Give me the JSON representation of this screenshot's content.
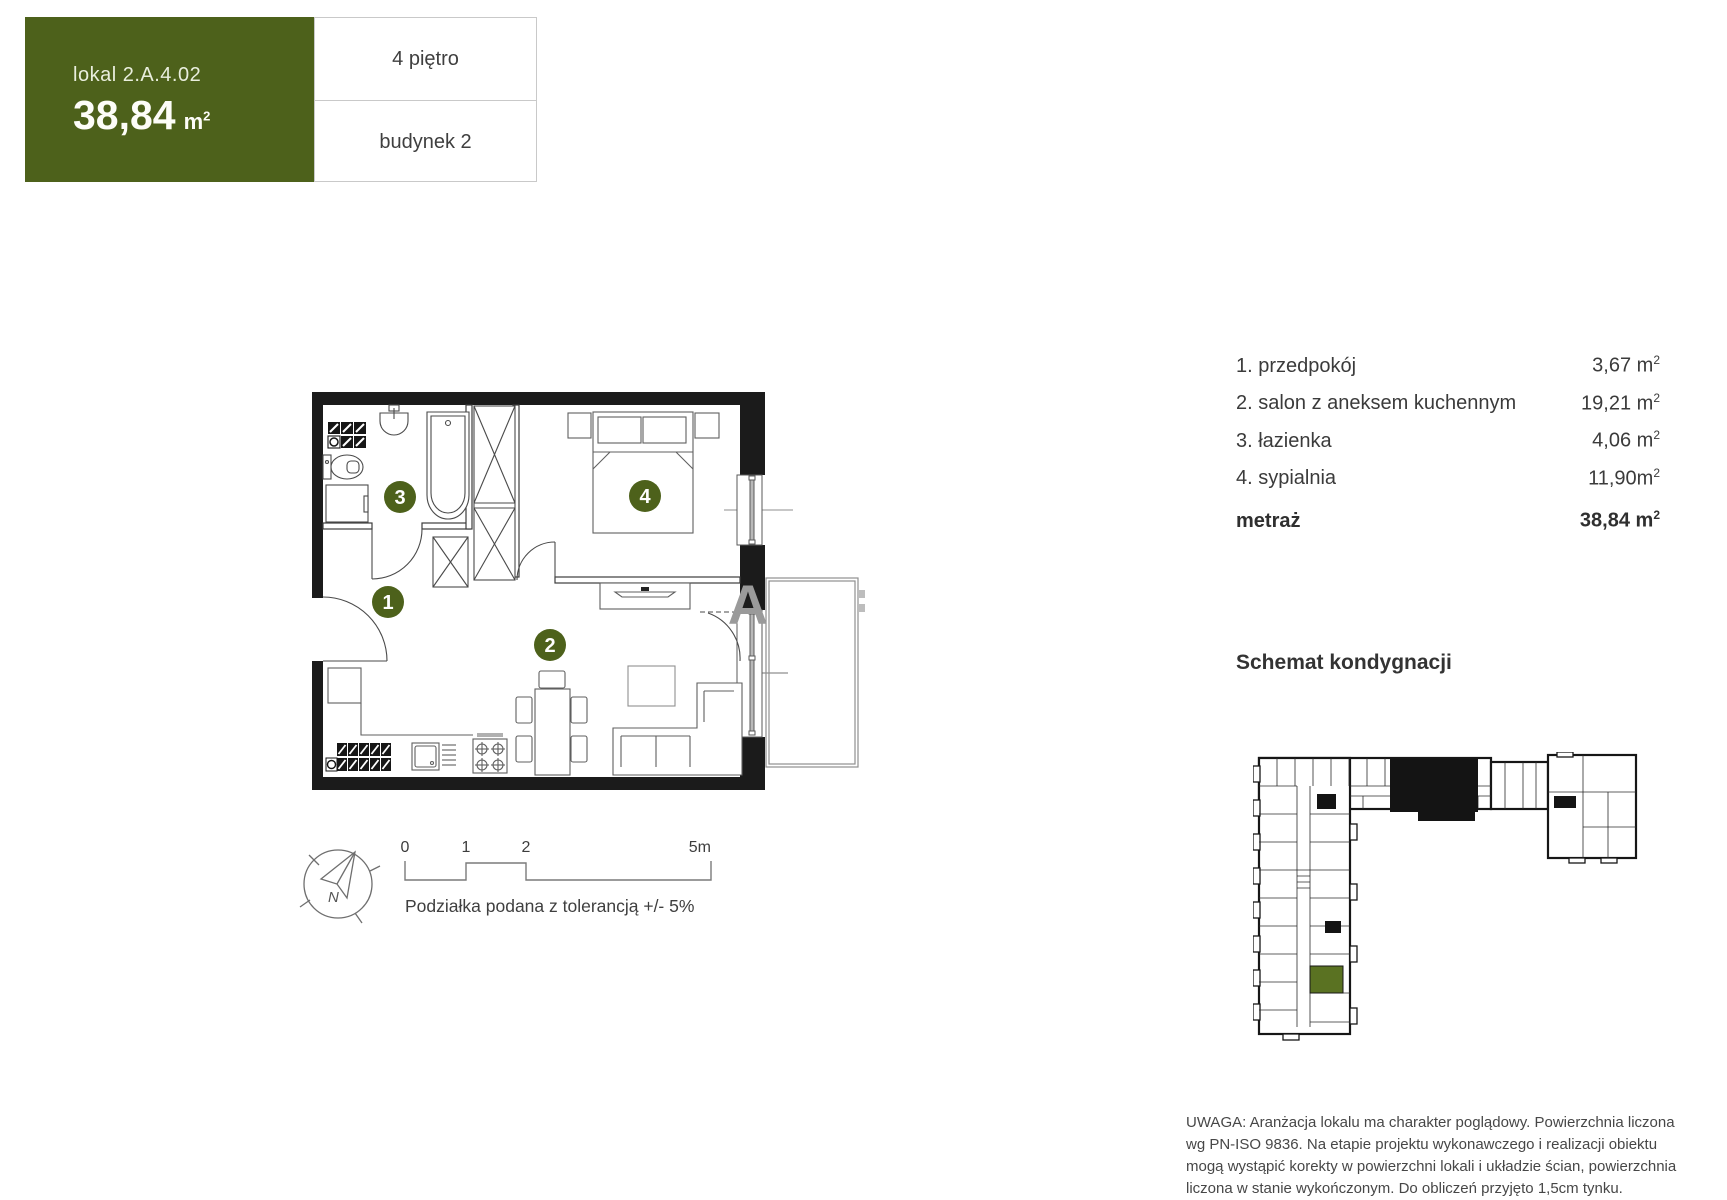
{
  "header": {
    "unit_label": "lokal 2.A.4.02",
    "area_value": "38,84",
    "area_unit": "m",
    "area_sup": "2",
    "floor_label": "4 piętro",
    "building_label": "budynek 2"
  },
  "room_list": {
    "rows": [
      {
        "name": "1. przedpokój",
        "area": "3,67 m",
        "sup": "2"
      },
      {
        "name": "2. salon z aneksem kuchennym",
        "area": "19,21 m",
        "sup": "2"
      },
      {
        "name": "3. łazienka",
        "area": "4,06 m",
        "sup": "2"
      },
      {
        "name": "4. sypialnia",
        "area": "11,90m",
        "sup": "2"
      }
    ],
    "total": {
      "label": "metraż",
      "area": "38,84 m",
      "sup": "2"
    }
  },
  "plan": {
    "badges": [
      "1",
      "2",
      "3",
      "4"
    ],
    "watermark": "A"
  },
  "compass": {
    "label": "N"
  },
  "scalebar": {
    "labels": [
      "0",
      "1",
      "2",
      "5m"
    ],
    "caption": "Podziałka podana z tolerancją +/- 5%"
  },
  "schematic": {
    "title": "Schemat kondygnacji"
  },
  "disclaimer": {
    "lines": [
      "UWAGA: Aranżacja lokalu ma charakter poglądowy. Powierzchnia liczona",
      "wg PN-ISO 9836. Na etapie projektu wykonawczego i realizacji obiektu",
      "mogą wystąpić korekty w powierzchni lokali i układzie ścian, powierzchnia",
      "liczona w stanie wykończonym. Do obliczeń przyjęto 1,5cm tynku."
    ]
  },
  "colors": {
    "accent": "#4d611b",
    "unit_highlight": "#5a7222",
    "wall": "#1b1b1b"
  }
}
